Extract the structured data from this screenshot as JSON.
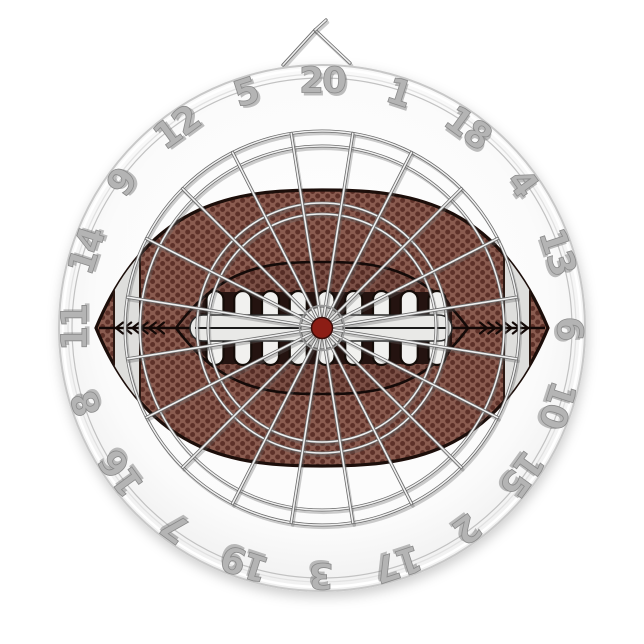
{
  "product": {
    "description": "Football dartboard with metal wire spider, wire number ring and hanging bracket",
    "background_color": "#ffffff"
  },
  "board": {
    "center_x": 322,
    "center_y": 328,
    "outer_radius": 263,
    "rim_inner_radius": 254,
    "number_ring_radius": 250,
    "number_radius": 247,
    "numbers": [
      "20",
      "1",
      "18",
      "4",
      "13",
      "6",
      "10",
      "15",
      "2",
      "17",
      "3",
      "19",
      "7",
      "16",
      "8",
      "11",
      "14",
      "9",
      "12",
      "5"
    ],
    "spoke_count": 20,
    "rings": {
      "double_outer": 197,
      "double_inner": 182,
      "triple_outer": 125,
      "triple_inner": 114,
      "bull_ring": 22.5
    },
    "colors": {
      "face": "#fbfbfb",
      "face_edge": "#efefef",
      "rim_line": "#c8c8c8",
      "rim_bright": "#ffffff",
      "wire_bright": "#f0f0f0",
      "wire_dark": "#6a6a6a",
      "wire_shadow": "rgba(100,100,100,0.32)",
      "number_fill": "#b4b4b4",
      "number_edge": "#8a8a8a",
      "number_shadow": "rgba(110,110,110,0.45)"
    }
  },
  "hanger": {
    "apex_x": 315,
    "apex_y": 30,
    "hook_x": 326,
    "hook_y": 20,
    "left_x": 283,
    "left_y": 65,
    "right_x": 350,
    "right_y": 63
  },
  "football": {
    "tip_left_x": 96,
    "tip_right_x": 548,
    "top_y": 190,
    "bottom_y": 466,
    "panel_tip_left_x": 176,
    "panel_tip_right_x": 468,
    "panel_top_y": 262,
    "panel_bottom_y": 394,
    "lace_count": 9,
    "lace_first_center_x": 215,
    "lace_spacing": 27.75,
    "lace_top_y": 291,
    "lace_height": 74,
    "lace_width": 17,
    "channel_x": 190,
    "channel_width": 262,
    "channel_y": 315,
    "channel_height": 26,
    "stripe_left_center_x": 127,
    "stripe_right_center_x": 517,
    "stripe_width": 26,
    "chevron_count": 6,
    "bull_radius": 10.5,
    "knot_radius": 21,
    "colors": {
      "leather_base": "#8a5c50",
      "pebble_dot": "#5d3129",
      "outline": "#1c0e0a",
      "panel_shade": "rgba(25,8,6,0.12)",
      "panel_outline": "#140a08",
      "stripe": "#dededc",
      "stripe_edge": "#2a1812",
      "lace_white": "#f1f1ef",
      "lace_outline": "#140c08",
      "lace_slot": "#241310",
      "seam": "#120806",
      "channel": "#e9e9e7",
      "channel_line": "#1a1a1a",
      "knot": "#ececea",
      "bull": "#8c1d15",
      "bull_edge": "#3a0d0a"
    }
  }
}
